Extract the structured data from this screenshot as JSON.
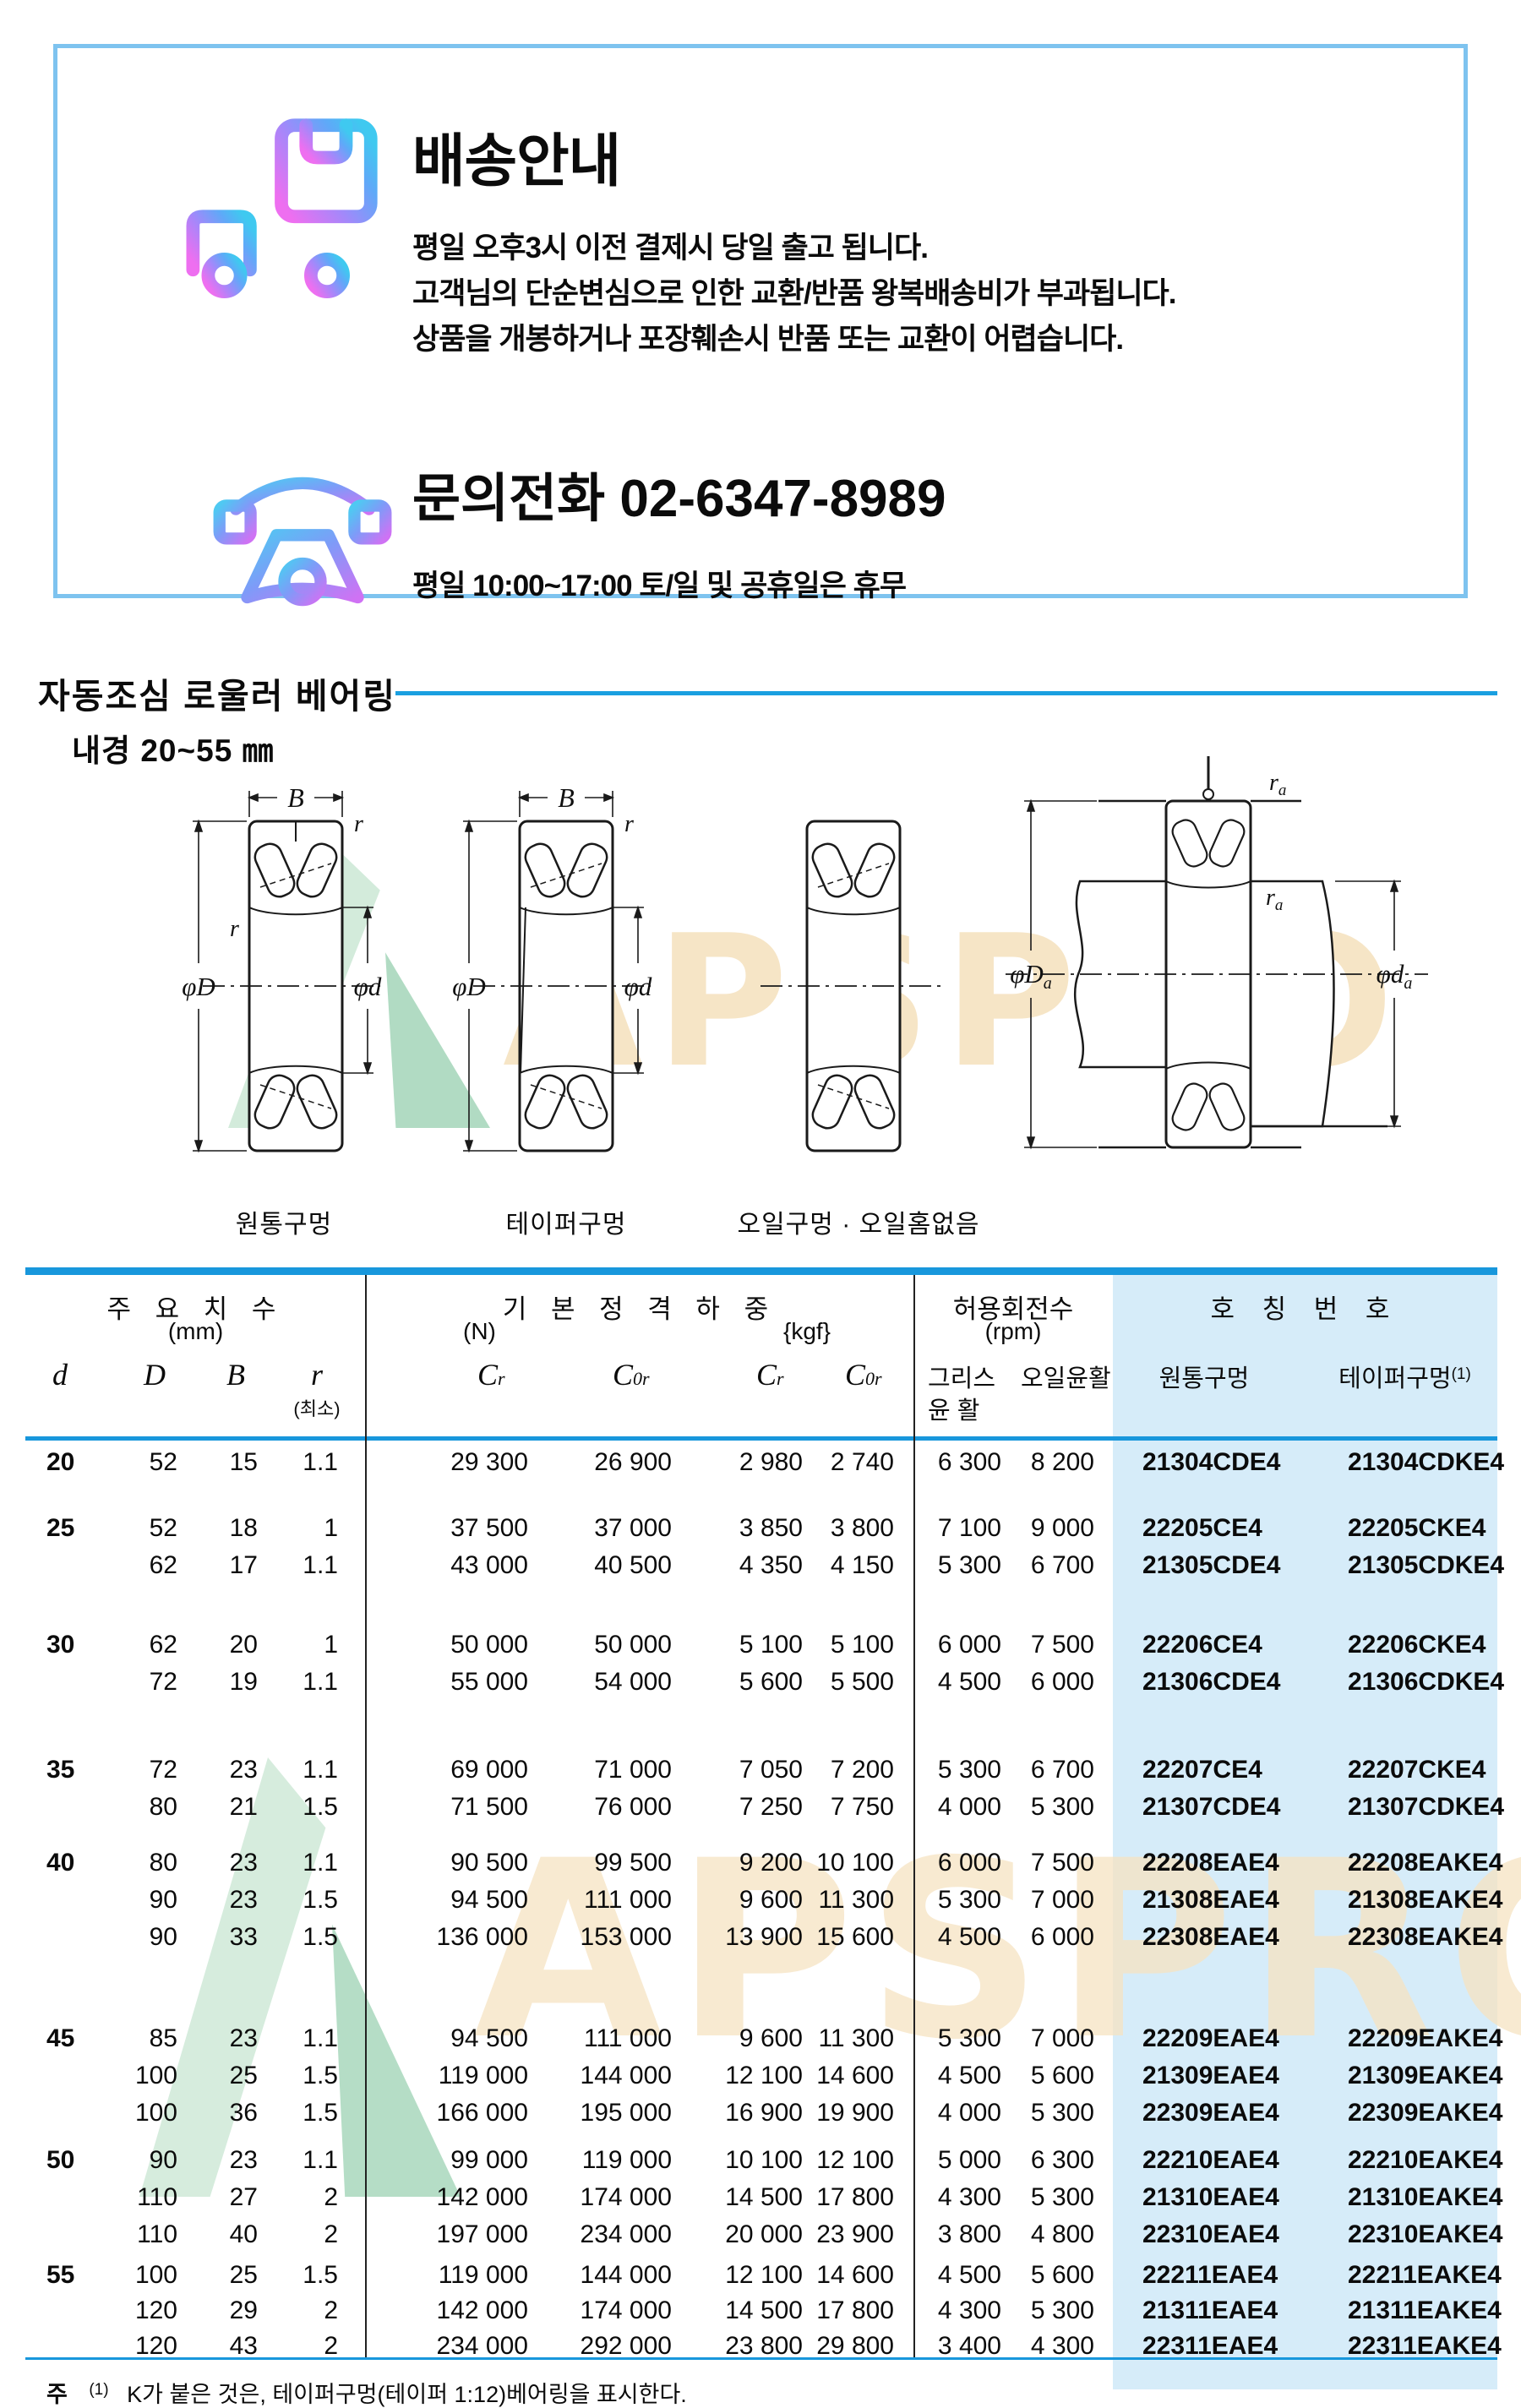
{
  "colors": {
    "accent_blue": "#1a9fe0",
    "light_blue_bg": "#d6ecf9",
    "box_border": "#7ec3ef",
    "watermark_cream": "#f6e3c2",
    "watermark_green_light": "#cfe9d8",
    "watermark_green_dark": "#a9d8bd"
  },
  "shipping_box": {
    "title": "배송안내",
    "line1": "평일 오후3시 이전 결제시 당일 출고 됩니다.",
    "line2": "고객님의 단순변심으로 인한 교환/반품 왕복배송비가 부과됩니다.",
    "line3": "상품을 개봉하거나 포장훼손시 반품 또는 교환이 어렵습니다.",
    "contact": "문의전화  02-6347-8989",
    "hours": "평일 10:00~17:00 토/일 및 공휴일은 휴무"
  },
  "section": {
    "title": "자동조심 로울러 베어링",
    "bore_range": "내경 20~55 ㎜"
  },
  "watermark": {
    "text": "APSPRO"
  },
  "diagram_labels": {
    "cylindrical": "원통구멍",
    "tapered": "테이퍼구멍",
    "oil": "오일구멍 · 오일홈없음"
  },
  "dims": {
    "B": "B",
    "r": "r",
    "a": "a",
    "phiD": "φD",
    "phid": "φd",
    "C": "C",
    "sub_r": "r",
    "sub_0r": "0r"
  },
  "table": {
    "headers": {
      "main_dims": "주 요 치 수",
      "main_dims_unit": "(mm)",
      "d": "d",
      "D": "D",
      "B": "B",
      "r": "r",
      "r_min": "(최소)",
      "basic_load": "기 본 정 격 하 중",
      "unit_n": "(N)",
      "unit_kgf": "{kgf}",
      "speed": "허용회전수",
      "speed_unit": "(rpm)",
      "grease1": "그리스",
      "grease2": "윤 활",
      "oil": "오일윤활",
      "bearing_no": "호 칭 번 호",
      "cyl_bore": "원통구멍",
      "taper_bore": "테이퍼구멍",
      "taper_ref": "(1)"
    },
    "groups": [
      {
        "d": "20",
        "rows": [
          {
            "D": "52",
            "B": "15",
            "r": "1.1",
            "cr_n": "29 300",
            "c0r_n": "26 900",
            "cr_kgf": "2 980",
            "c0r_kgf": "2 740",
            "grease": "6 300",
            "oil": "8 200",
            "cyl": "21304CDE4",
            "taper": "21304CDKE4"
          }
        ]
      },
      {
        "d": "25",
        "rows": [
          {
            "D": "52",
            "B": "18",
            "r": "1",
            "cr_n": "37 500",
            "c0r_n": "37 000",
            "cr_kgf": "3 850",
            "c0r_kgf": "3 800",
            "grease": "7 100",
            "oil": "9 000",
            "cyl": "22205CE4",
            "taper": "22205CKE4"
          },
          {
            "D": "62",
            "B": "17",
            "r": "1.1",
            "cr_n": "43 000",
            "c0r_n": "40 500",
            "cr_kgf": "4 350",
            "c0r_kgf": "4 150",
            "grease": "5 300",
            "oil": "6 700",
            "cyl": "21305CDE4",
            "taper": "21305CDKE4"
          }
        ]
      },
      {
        "d": "30",
        "rows": [
          {
            "D": "62",
            "B": "20",
            "r": "1",
            "cr_n": "50 000",
            "c0r_n": "50 000",
            "cr_kgf": "5 100",
            "c0r_kgf": "5 100",
            "grease": "6 000",
            "oil": "7 500",
            "cyl": "22206CE4",
            "taper": "22206CKE4"
          },
          {
            "D": "72",
            "B": "19",
            "r": "1.1",
            "cr_n": "55 000",
            "c0r_n": "54 000",
            "cr_kgf": "5 600",
            "c0r_kgf": "5 500",
            "grease": "4 500",
            "oil": "6 000",
            "cyl": "21306CDE4",
            "taper": "21306CDKE4"
          }
        ]
      },
      {
        "d": "35",
        "rows": [
          {
            "D": "72",
            "B": "23",
            "r": "1.1",
            "cr_n": "69 000",
            "c0r_n": "71 000",
            "cr_kgf": "7 050",
            "c0r_kgf": "7 200",
            "grease": "5 300",
            "oil": "6 700",
            "cyl": "22207CE4",
            "taper": "22207CKE4"
          },
          {
            "D": "80",
            "B": "21",
            "r": "1.5",
            "cr_n": "71 500",
            "c0r_n": "76 000",
            "cr_kgf": "7 250",
            "c0r_kgf": "7 750",
            "grease": "4 000",
            "oil": "5 300",
            "cyl": "21307CDE4",
            "taper": "21307CDKE4"
          }
        ]
      },
      {
        "d": "40",
        "rows": [
          {
            "D": "80",
            "B": "23",
            "r": "1.1",
            "cr_n": "90 500",
            "c0r_n": "99 500",
            "cr_kgf": "9 200",
            "c0r_kgf": "10 100",
            "grease": "6 000",
            "oil": "7 500",
            "cyl": "22208EAE4",
            "taper": "22208EAKE4"
          },
          {
            "D": "90",
            "B": "23",
            "r": "1.5",
            "cr_n": "94 500",
            "c0r_n": "111 000",
            "cr_kgf": "9 600",
            "c0r_kgf": "11 300",
            "grease": "5 300",
            "oil": "7 000",
            "cyl": "21308EAE4",
            "taper": "21308EAKE4"
          },
          {
            "D": "90",
            "B": "33",
            "r": "1.5",
            "cr_n": "136 000",
            "c0r_n": "153 000",
            "cr_kgf": "13 900",
            "c0r_kgf": "15 600",
            "grease": "4 500",
            "oil": "6 000",
            "cyl": "22308EAE4",
            "taper": "22308EAKE4"
          }
        ]
      },
      {
        "d": "45",
        "rows": [
          {
            "D": "85",
            "B": "23",
            "r": "1.1",
            "cr_n": "94 500",
            "c0r_n": "111 000",
            "cr_kgf": "9 600",
            "c0r_kgf": "11 300",
            "grease": "5 300",
            "oil": "7 000",
            "cyl": "22209EAE4",
            "taper": "22209EAKE4"
          },
          {
            "D": "100",
            "B": "25",
            "r": "1.5",
            "cr_n": "119 000",
            "c0r_n": "144 000",
            "cr_kgf": "12 100",
            "c0r_kgf": "14 600",
            "grease": "4 500",
            "oil": "5 600",
            "cyl": "21309EAE4",
            "taper": "21309EAKE4"
          },
          {
            "D": "100",
            "B": "36",
            "r": "1.5",
            "cr_n": "166 000",
            "c0r_n": "195 000",
            "cr_kgf": "16 900",
            "c0r_kgf": "19 900",
            "grease": "4 000",
            "oil": "5 300",
            "cyl": "22309EAE4",
            "taper": "22309EAKE4"
          }
        ]
      },
      {
        "d": "50",
        "rows": [
          {
            "D": "90",
            "B": "23",
            "r": "1.1",
            "cr_n": "99 000",
            "c0r_n": "119 000",
            "cr_kgf": "10 100",
            "c0r_kgf": "12 100",
            "grease": "5 000",
            "oil": "6 300",
            "cyl": "22210EAE4",
            "taper": "22210EAKE4"
          },
          {
            "D": "110",
            "B": "27",
            "r": "2",
            "cr_n": "142 000",
            "c0r_n": "174 000",
            "cr_kgf": "14 500",
            "c0r_kgf": "17 800",
            "grease": "4 300",
            "oil": "5 300",
            "cyl": "21310EAE4",
            "taper": "21310EAKE4"
          },
          {
            "D": "110",
            "B": "40",
            "r": "2",
            "cr_n": "197 000",
            "c0r_n": "234 000",
            "cr_kgf": "20 000",
            "c0r_kgf": "23 900",
            "grease": "3 800",
            "oil": "4 800",
            "cyl": "22310EAE4",
            "taper": "22310EAKE4"
          }
        ]
      },
      {
        "d": "55",
        "rows": [
          {
            "D": "100",
            "B": "25",
            "r": "1.5",
            "cr_n": "119 000",
            "c0r_n": "144 000",
            "cr_kgf": "12 100",
            "c0r_kgf": "14 600",
            "grease": "4 500",
            "oil": "5 600",
            "cyl": "22211EAE4",
            "taper": "22211EAKE4"
          },
          {
            "D": "120",
            "B": "29",
            "r": "2",
            "cr_n": "142 000",
            "c0r_n": "174 000",
            "cr_kgf": "14 500",
            "c0r_kgf": "17 800",
            "grease": "4 300",
            "oil": "5 300",
            "cyl": "21311EAE4",
            "taper": "21311EAKE4"
          },
          {
            "D": "120",
            "B": "43",
            "r": "2",
            "cr_n": "234 000",
            "c0r_n": "292 000",
            "cr_kgf": "23 800",
            "c0r_kgf": "29 800",
            "grease": "3 400",
            "oil": "4 300",
            "cyl": "22311EAE4",
            "taper": "22311EAKE4"
          }
        ]
      }
    ]
  },
  "footnote": {
    "mark": "주",
    "ref": "(1)",
    "text": "K가 붙은 것은, 테이퍼구멍(테이퍼 1:12)베어링을 표시한다."
  }
}
